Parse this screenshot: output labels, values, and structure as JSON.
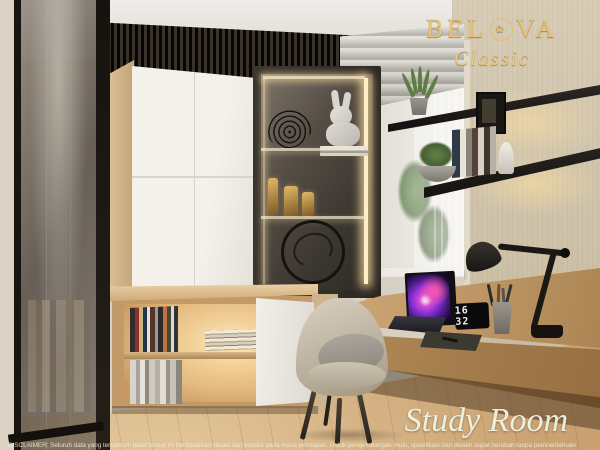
{
  "branding": {
    "brand_name": "BELOVA",
    "brand_left": "BEL",
    "brand_right": "VA",
    "emblem_glyph": "✿",
    "collection": "Classic"
  },
  "caption": {
    "room_label": "Study Room"
  },
  "desk": {
    "clock_time": "16 32"
  },
  "footer": {
    "disclaimer": "DISCLAIMER: Seluruh data yang tercantum pada brosur ini berdasarkan situasi dan kondisi pada masa persiapan. Untuk pengembangan mutu, spesifikasi dan desain dapat berubah tanpa pemberitahuan"
  },
  "palette": {
    "brand_gold": "#e7c377",
    "wood_light": "#cfa97a",
    "wall_beige": "#cec1a9",
    "led_warm": "#ffe3a6",
    "shelf_black": "#1d1a17",
    "laptop_screen_accent": "#a23ad1",
    "caption_cream": "#eeeedd"
  }
}
